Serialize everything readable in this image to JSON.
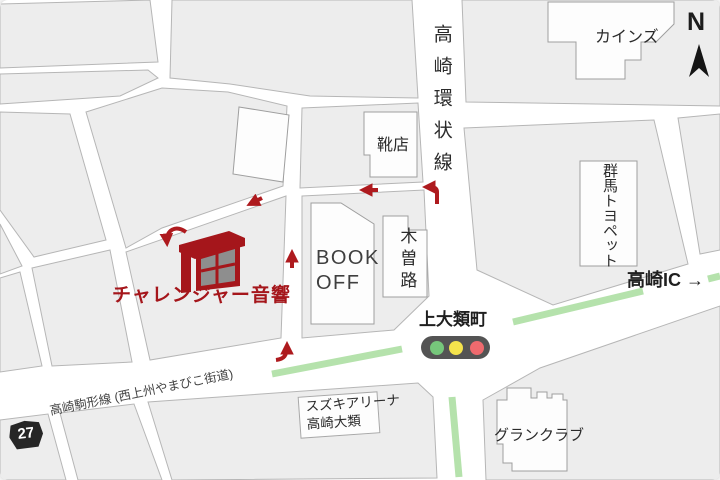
{
  "map_labels": {
    "store": {
      "name": "チャレンジャー音響"
    },
    "ring_road": "高崎環状線",
    "main_road": "高崎駒形線 (西上州やまびこ街道)",
    "route_number": "27",
    "highway_direction": "高崎IC →",
    "intersection": "上大類町",
    "shoe_store": "靴店",
    "bookoff_line1": "BOOK",
    "bookoff_line2": "OFF",
    "kisoji": "木曽路",
    "cainz": "カインズ",
    "gunma_toyopet": "群馬トヨペット",
    "suzuki_line1": "スズキアリーナ",
    "suzuki_line2": "高崎大類",
    "grand_club": "グランクラブ",
    "compass_north": "N"
  },
  "colors": {
    "accent_red": "#ae1a1e",
    "store_text_red": "#a5161b",
    "road_median_green": "#b5e2ac",
    "signal_green": "#76c77b",
    "signal_yellow": "#f4e34c",
    "signal_red": "#ee6a6e",
    "block_gray": "#ededed",
    "building_white": "#fdfdfd",
    "badge_black": "#262626"
  }
}
